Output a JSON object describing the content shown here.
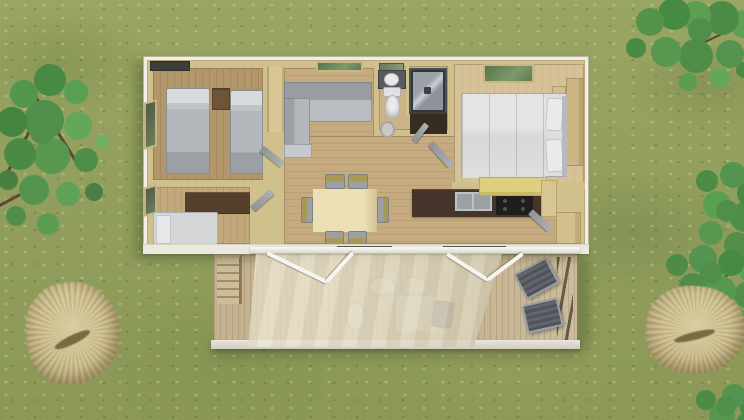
{
  "scene": {
    "title": "Aerial 3D floor-plan render of a two-bedroom mobile home with wooden deck and awning on a grass lawn",
    "environment": {
      "ground": "grass lawn",
      "vegetation": [
        {
          "name": "tree-top-left"
        },
        {
          "name": "tree-top-right"
        },
        {
          "name": "tree-right-middle"
        },
        {
          "name": "tree-bottom-right"
        },
        {
          "name": "ornamental-grass-left"
        },
        {
          "name": "ornamental-grass-right"
        }
      ]
    },
    "house": {
      "rooms": [
        {
          "name": "twin-bedroom",
          "furniture": [
            "twin-bed-left",
            "twin-bed-right",
            "nightstand",
            "left-wall-window",
            "top-wall-window"
          ]
        },
        {
          "name": "second-bedroom",
          "furniture": [
            "double-bed",
            "dark-wardrobe",
            "left-wall-window"
          ]
        },
        {
          "name": "living-room",
          "furniture": [
            "corner-sofa",
            "tall-cabinet",
            "top-wall-window"
          ]
        },
        {
          "name": "dining-area",
          "furniture": [
            "dining-table",
            "chair-top-1",
            "chair-top-2",
            "chair-bottom-1",
            "chair-bottom-2",
            "chair-left",
            "chair-right"
          ]
        },
        {
          "name": "bathroom",
          "furniture": [
            "mirror",
            "vanity-sink",
            "toilet",
            "shower-cabin",
            "dark-cabinet",
            "round-basket"
          ]
        },
        {
          "name": "master-bedroom",
          "furniture": [
            "double-bed-with-pillows",
            "wardrobe",
            "nightstand",
            "skylight"
          ]
        },
        {
          "name": "kitchen",
          "furniture": [
            "dark-counter",
            "double-sink",
            "cooktop",
            "yellow-bar-counter",
            "tall-cabinet",
            "corner-cabinet"
          ]
        }
      ],
      "door_count": 5,
      "sliding_glass_panels": 2
    },
    "deck": {
      "features": [
        "wood-planks",
        "entry-stairs",
        "handrail",
        "baluster-railing",
        "fascia-board",
        "awning-canopy",
        "awning-frame-poles"
      ],
      "furniture": [
        "lounge-chair-1",
        "lounge-chair-2",
        "patio-chair-a",
        "patio-chair-b",
        "side-chair",
        "patio-table",
        "covered-dark-chair"
      ]
    },
    "palette": {
      "grass": "#93a05e",
      "wall": "#cfc08c",
      "house_outer": "#f1eee6",
      "floor_wood": "#c5ab7f",
      "floor_master": "#d6c299",
      "deck_wood": "#c9b897",
      "awning_fabric": "#e9e3cf",
      "counter_dark": "#46332a",
      "counter_yellow": "#ddd180",
      "sofa_gray": "#b7bbc0",
      "bed_white": "#dcdee0",
      "foliage_green": "#4f8f4b",
      "ornamental_grass": "#cfc291"
    }
  }
}
